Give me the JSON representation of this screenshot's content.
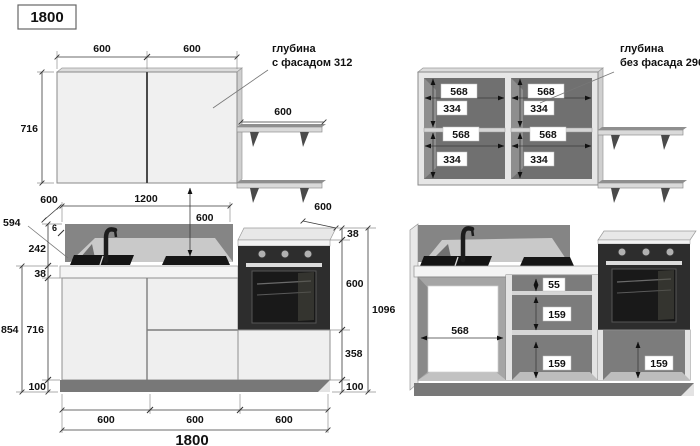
{
  "title": "1800",
  "upper_left": {
    "dim_door1": "600",
    "dim_door2": "600",
    "dim_height": "716",
    "dim_shelf": "600",
    "note1": "глубина",
    "note2": "с фасадом 312"
  },
  "upper_right": {
    "c1w": "568",
    "c1h": "334",
    "c2w": "568",
    "c2h": "334",
    "c3w": "568",
    "c3h": "334",
    "c4w": "568",
    "c4h": "334",
    "note1": "глубина",
    "note2": "без фасада 296"
  },
  "lower_left": {
    "dim_depth_back": "600",
    "dim_width_counter": "1200",
    "dim_wall_gap": "600",
    "dim_side": "594",
    "dim_panel": "6",
    "dim_backsplash": "242",
    "dim_top_thickness": "38",
    "dim_total_left": "854",
    "dim_carcass": "716",
    "dim_plinth": "100",
    "dim_oven_top": "38",
    "dim_oven_h": "600",
    "dim_oven_depth": "600",
    "dim_drawer_zone": "358",
    "dim_plinth_r": "100",
    "dim_total_right": "1096",
    "dim_b1": "600",
    "dim_b2": "600",
    "dim_b3": "600",
    "dim_total_width": "1800"
  },
  "lower_right": {
    "dim_back_width": "568",
    "dim_gap": "55",
    "dim_d1": "159",
    "dim_d2": "159",
    "dim_d3": "159"
  }
}
